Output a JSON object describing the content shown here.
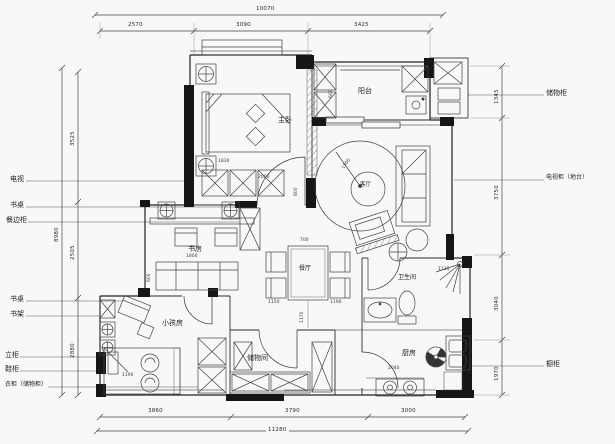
{
  "rooms": [
    {
      "label": "主卧"
    },
    {
      "label": "阳台"
    },
    {
      "label": "客厅"
    },
    {
      "label": "书房"
    },
    {
      "label": "餐厅"
    },
    {
      "label": "小孩房"
    },
    {
      "label": "储物间"
    },
    {
      "label": "卫生间"
    },
    {
      "label": "厨房"
    }
  ],
  "callouts_left": [
    {
      "label": "电视"
    },
    {
      "label": "书桌"
    },
    {
      "label": "餐边柜"
    },
    {
      "label": "书桌"
    },
    {
      "label": "书架"
    },
    {
      "label": "立柜"
    },
    {
      "label": "鞋柜"
    },
    {
      "label": "衣柜（储物柜）"
    }
  ],
  "callouts_right": [
    {
      "label": "储物柜"
    },
    {
      "label": "电视柜（地台）"
    },
    {
      "label": "橱柜"
    }
  ],
  "dimensions": {
    "top_total": "10070",
    "top_segments": [
      "2570",
      "3090",
      "3425"
    ],
    "bottom_segments": [
      "3860",
      "3790",
      "3000"
    ],
    "bottom_total": "11280",
    "left_total": "8980",
    "left_segments": [
      "3525",
      "2505",
      "2880"
    ],
    "right_segments": [
      "1345",
      "3750",
      "3040",
      "1970"
    ],
    "interior": [
      "1830",
      "2000",
      "800",
      "600",
      "1500",
      "1800",
      "600",
      "700",
      "1150",
      "1190",
      "1170",
      "1190",
      "1135",
      "2040"
    ]
  }
}
